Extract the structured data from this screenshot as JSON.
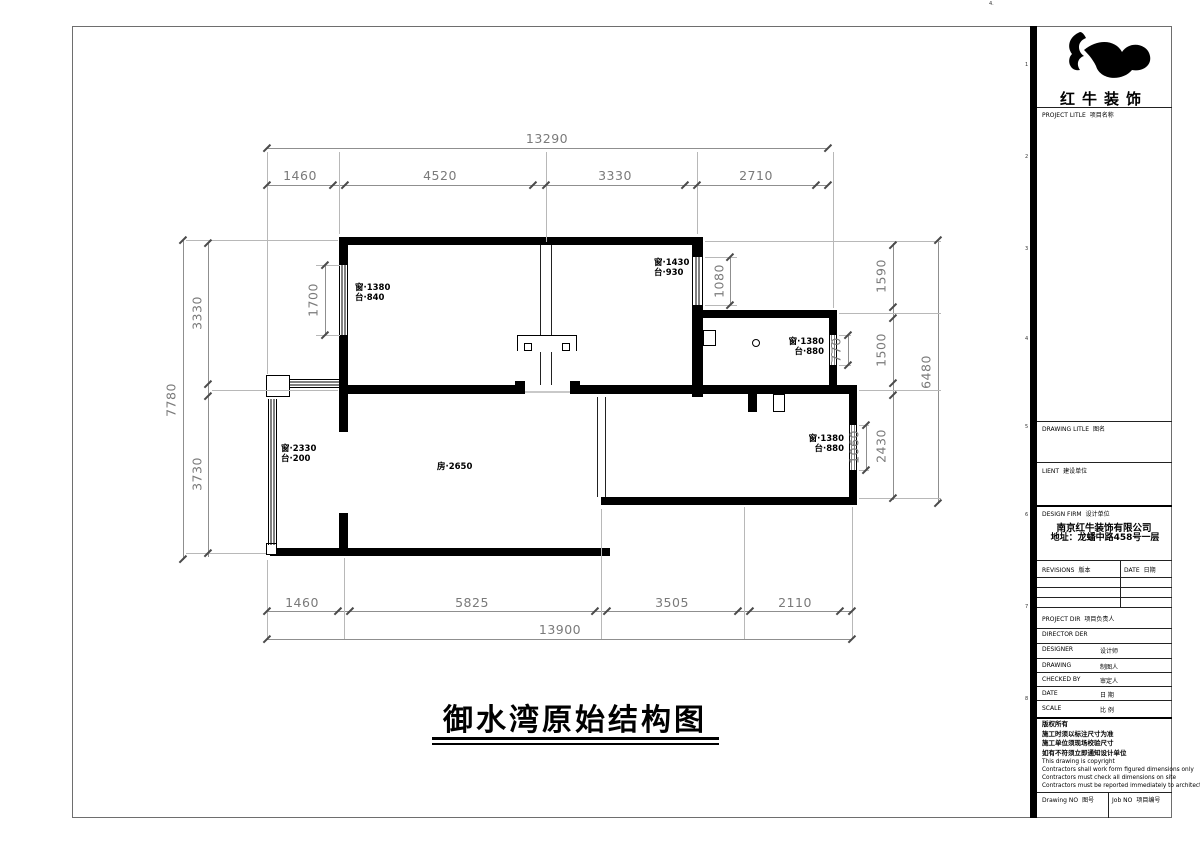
{
  "colors": {
    "wall": "#000000",
    "dimension": "#808080",
    "paper": "#ffffff"
  },
  "sheet": {
    "corner_mark": "4.",
    "edge_marks": [
      "1",
      "2",
      "3",
      "4",
      "5",
      "6",
      "7",
      "8"
    ]
  },
  "drawing": {
    "title": "御水湾原始结构图",
    "room_label": "房·2650",
    "windows": {
      "bed1": {
        "l1": "窗·1380",
        "l2": "台·840",
        "dim": "1700"
      },
      "bed2": {
        "l1": "窗·1430",
        "l2": "台·930",
        "dim": "1080"
      },
      "kitchen": {
        "l1": "窗·1380",
        "l2": "台·880",
        "dim": "770"
      },
      "room_br": {
        "l1": "窗·1380",
        "l2": "台·880",
        "dim": "1060"
      },
      "balcony": {
        "l1": "窗·2330",
        "l2": "台·200"
      }
    },
    "dims": {
      "top_overall": "13290",
      "top_chain": [
        "1460",
        "4520",
        "3330",
        "2710"
      ],
      "bottom_chain": [
        "1460",
        "5825",
        "3505",
        "2110"
      ],
      "bottom_overall": "13900",
      "left_overall": "7780",
      "left_chain": [
        "3330",
        "3730"
      ],
      "right_chain": [
        "1590",
        "1500",
        "2430"
      ],
      "right_overall": "6480"
    }
  },
  "title_block": {
    "logo_name": "红牛装饰",
    "project_title": {
      "en": "PROJECT LITLE",
      "cn": "项目名称"
    },
    "drawing_title": {
      "en": "DRAWING LITLE",
      "cn": "图名"
    },
    "client": {
      "en": "LIENT",
      "cn": "建设单位"
    },
    "design_firm": {
      "en": "DESIGN FIRM",
      "cn": "设计单位"
    },
    "firm_name": "南京红牛装饰有限公司",
    "firm_address": "地址：龙蟠中路458号一层",
    "revisions": {
      "en": "REVISIONS",
      "cn": "版本"
    },
    "date_col": {
      "en": "DATE",
      "cn": "日期"
    },
    "project_dir": {
      "en": "PROJECT DIR",
      "cn": "项目负责人"
    },
    "director": {
      "en": "DIRECTOR DER",
      "cn": ""
    },
    "designer": {
      "en": "DESIGNER",
      "cn": "设计师"
    },
    "drafter": {
      "en": "DRAWING",
      "cn": "制图人"
    },
    "checked": {
      "en": "CHECKED BY",
      "cn": "审定人"
    },
    "date": {
      "en": "DATE",
      "cn": "日 期"
    },
    "scale": {
      "en": "SCALE",
      "cn": "比 例"
    },
    "copyright": [
      "版权所有",
      "施工时须以标注尺寸为准",
      "施工单位须现场校验尺寸",
      "如有不符须立即通知设计单位",
      "This drawing is copyright",
      "Contractors shall work form figured dimensions only",
      "Contractors must check all dimensions on site",
      "Contractors must be reported immediately to architects"
    ],
    "drawing_no": {
      "en": "Drawing NO",
      "cn": "图号"
    },
    "job_no": {
      "en": "Job NO",
      "cn": "项目编号"
    }
  }
}
